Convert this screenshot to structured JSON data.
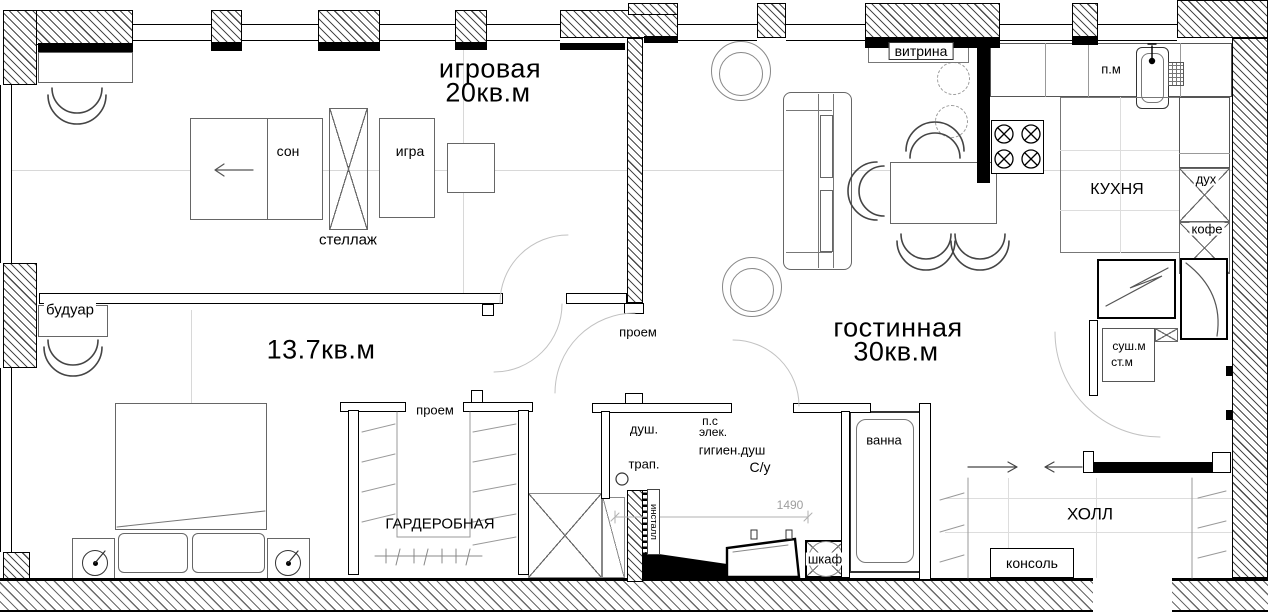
{
  "labels": {
    "playroom": "игровая",
    "playroom_area": "20кв.м",
    "bedroom_area": "13.7кв.м",
    "livingroom": "гостинная",
    "livingroom_area": "30кв.м",
    "kitchen": "КУХНЯ",
    "wardrobe_room": "ГАРДЕРОБНАЯ",
    "hall": "ХОЛЛ",
    "sleep": "сон",
    "play": "игра",
    "shelving": "стеллаж",
    "boudoir": "будуар",
    "opening_center": "проем",
    "opening_wardrobe": "проем",
    "display_case": "витрина",
    "dishwasher": "п.м",
    "oven": "дух",
    "coffee": "кофе",
    "dryer": "суш.м",
    "washer": "ст.м",
    "shower": "душ.",
    "drain": "трап.",
    "ps": "п.с",
    "elec": "элек.",
    "hygienic_shower": "гигиен.душ",
    "wc": "С/у",
    "bath": "ванна",
    "cabinet": "шкаф",
    "installation": "инсталл",
    "console": "консоль",
    "dimension_1490": "1490"
  },
  "colors": {
    "ink": "#000000",
    "furniture_line": "#666666",
    "faint_line": "#d8d8d8",
    "dimension": "#9e9e9e"
  }
}
